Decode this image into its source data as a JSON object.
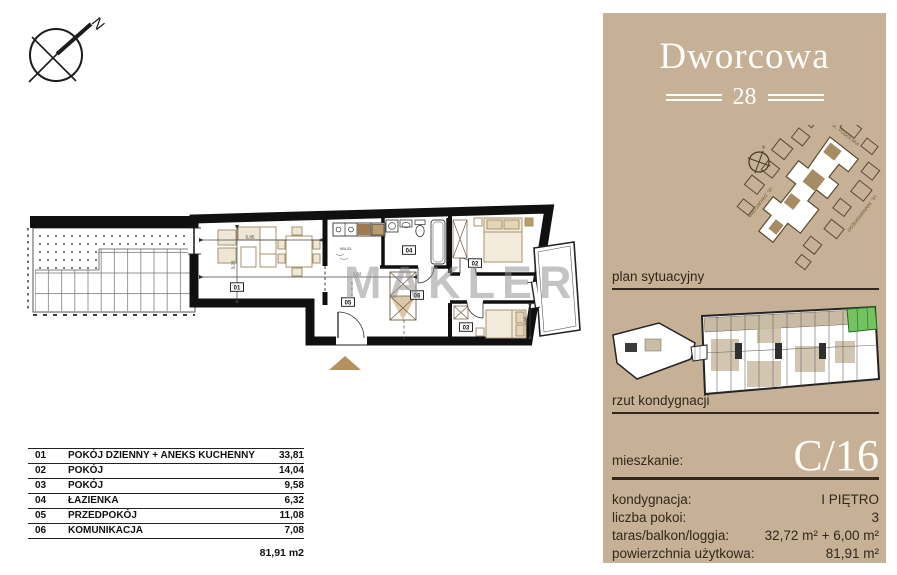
{
  "compass": {
    "label": "N"
  },
  "floor_plan": {
    "watermark": "MAKLER",
    "annotation": "KBL/ZL",
    "room_labels": [
      "01",
      "02",
      "03",
      "04",
      "05",
      "06"
    ],
    "dim_labels": [
      "5,85",
      "2,62",
      "3,20",
      "2,95"
    ]
  },
  "sidebar": {
    "brand": {
      "name": "Dworcowa",
      "number": "28"
    },
    "site_plan": {
      "caption": "plan sytuacyjny",
      "compass_label": "N",
      "streets": [
        "UL. PODOLSKA",
        "UL. WARMIŃSKIEGO",
        "UL. DWORCOWA"
      ]
    },
    "floor_overview": {
      "caption": "rzut kondygnacji"
    },
    "apartment": {
      "label": "mieszkanie:",
      "id": "C/16"
    },
    "details": [
      {
        "label": "kondygnacja:",
        "value": "I PIĘTRO"
      },
      {
        "label": "liczba pokoi:",
        "value": "3"
      },
      {
        "label": "taras/balkon/loggia:",
        "value": "32,72 m² + 6,00 m²"
      },
      {
        "label": "powierzchnia użytkowa:",
        "value": "81,91 m²"
      }
    ]
  },
  "rooms_table": {
    "rows": [
      {
        "no": "01",
        "name": "POKÓJ DZIENNY + ANEKS KUCHENNY",
        "area": "33,81"
      },
      {
        "no": "02",
        "name": "POKÓJ",
        "area": "14,04"
      },
      {
        "no": "03",
        "name": "POKÓJ",
        "area": "9,58"
      },
      {
        "no": "04",
        "name": "ŁAZIENKA",
        "area": "6,32"
      },
      {
        "no": "05",
        "name": "PRZEDPOKÓJ",
        "area": "11,08"
      },
      {
        "no": "06",
        "name": "KOMUNIKACJA",
        "area": "7,08"
      }
    ],
    "total": "81,91 m2"
  },
  "colors": {
    "sidebar_tan": "#c6b197",
    "dark_brown_text": "#32271c",
    "highlight_green": "#74c361",
    "wood_brown": "#b3925d"
  }
}
